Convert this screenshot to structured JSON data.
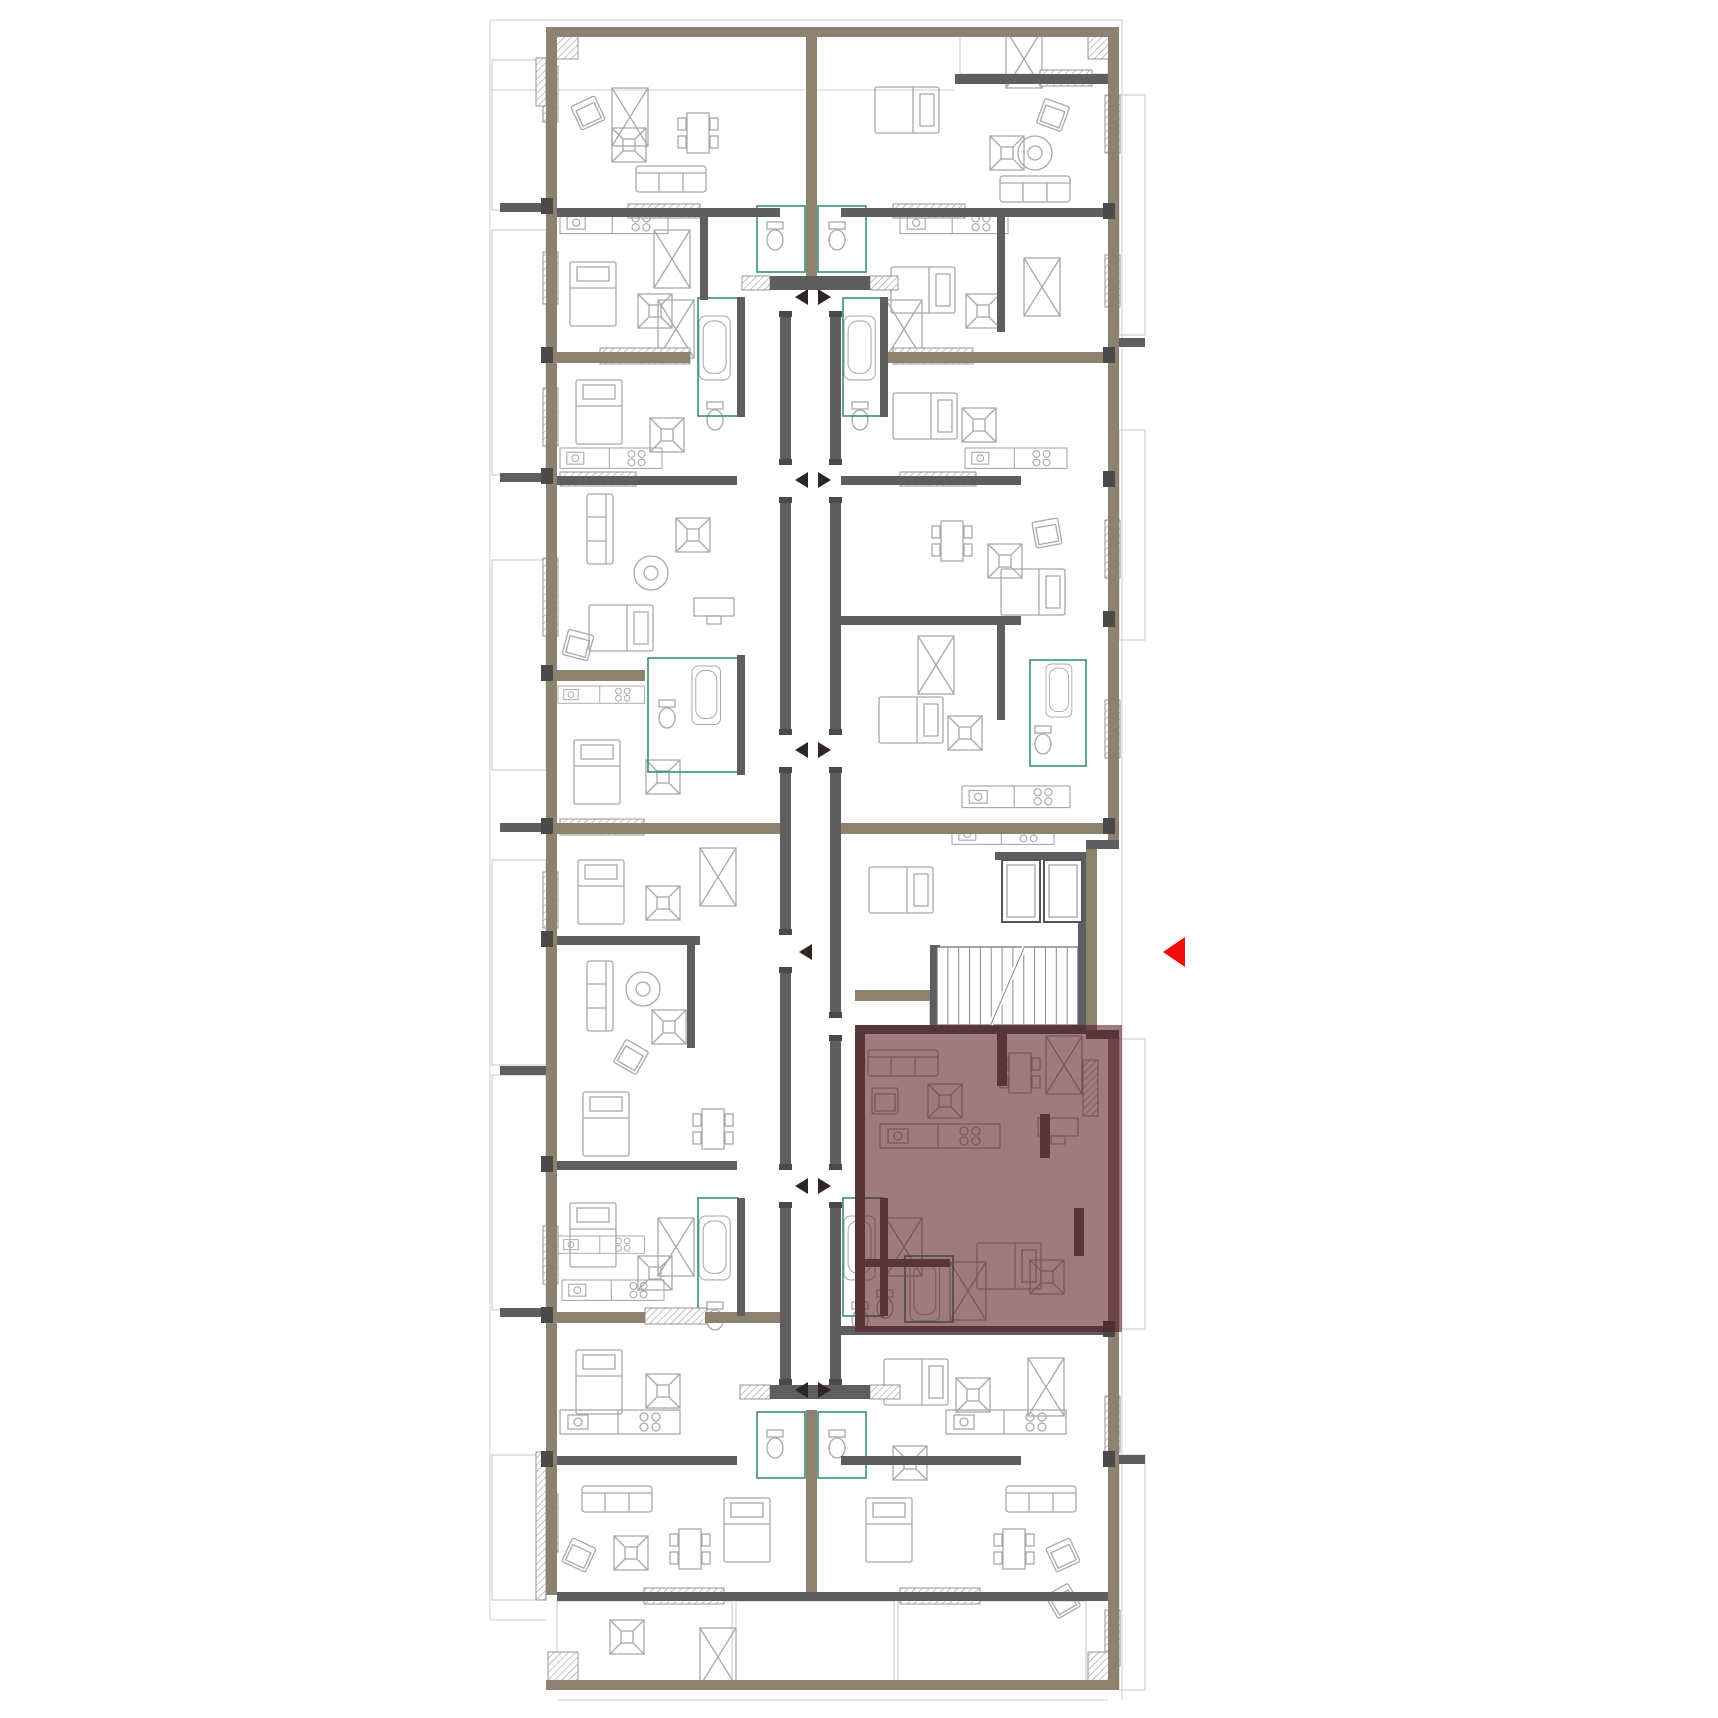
{
  "canvas": {
    "w": 1718,
    "h": 1718,
    "bg": "#ffffff"
  },
  "colors": {
    "wall_olive": "#8d8170",
    "wall_gray": "#5e5e5e",
    "furniture_line": "#a9a9a9",
    "balcony_line": "#c7c7c7",
    "bathroom_green": "#3d8f6e",
    "marker_dark": "#2f2624",
    "highlight_fill": "rgba(84,22,34,0.57)",
    "arrow_red": "#f20d0d",
    "hatch_line": "#9a9a9a"
  },
  "guide_lines": [
    [
      490,
      20,
      1122,
      20
    ],
    [
      490,
      90,
      955,
      90
    ],
    [
      490,
      20,
      490,
      1620
    ],
    [
      1122,
      20,
      1122,
      1700
    ],
    [
      557,
      1700,
      1108,
      1700
    ],
    [
      490,
      1620,
      546,
      1620
    ]
  ],
  "balconies": [
    [
      492,
      60,
      54,
      150
    ],
    [
      492,
      230,
      54,
      245
    ],
    [
      492,
      560,
      54,
      210
    ],
    [
      492,
      860,
      54,
      205
    ],
    [
      492,
      1075,
      54,
      235
    ],
    [
      492,
      1455,
      54,
      145
    ],
    [
      1119,
      95,
      26,
      240
    ],
    [
      1119,
      430,
      26,
      210
    ],
    [
      1119,
      1039,
      26,
      290
    ],
    [
      1119,
      1455,
      26,
      235
    ],
    [
      557,
      1601,
      175,
      80
    ],
    [
      736,
      1601,
      158,
      80
    ],
    [
      898,
      1601,
      188,
      80
    ],
    [
      960,
      32,
      148,
      42
    ]
  ],
  "green_rooms": [
    [
      757,
      206,
      48,
      66
    ],
    [
      818,
      206,
      48,
      66
    ],
    [
      698,
      298,
      40,
      118
    ],
    [
      843,
      298,
      40,
      118
    ],
    [
      648,
      658,
      90,
      114
    ],
    [
      1030,
      660,
      56,
      106
    ],
    [
      698,
      1198,
      40,
      118
    ],
    [
      843,
      1198,
      40,
      118
    ],
    [
      757,
      1412,
      48,
      66
    ],
    [
      818,
      1412,
      48,
      66
    ],
    [
      905,
      1256,
      48,
      66
    ]
  ],
  "furniture": [
    [
      "armchair",
      575,
      100,
      -25
    ],
    [
      "table",
      612,
      128,
      0
    ],
    [
      "dining",
      678,
      106,
      0
    ],
    [
      "sofa",
      636,
      166,
      0
    ],
    [
      "ward",
      612,
      88,
      0
    ],
    [
      "bed",
      884,
      78,
      90
    ],
    [
      "table",
      990,
      136,
      0
    ],
    [
      "round",
      1018,
      136,
      0
    ],
    [
      "armchair",
      1040,
      102,
      20
    ],
    [
      "sofa",
      1000,
      176,
      0
    ],
    [
      "ward",
      1006,
      30,
      0
    ],
    [
      "kitchen",
      560,
      212,
      0,
      0.9
    ],
    [
      "kitchen",
      900,
      212,
      0,
      0.9
    ],
    [
      "toilet",
      764,
      222,
      0
    ],
    [
      "toilet",
      826,
      222,
      0
    ],
    [
      "bed",
      570,
      262,
      0
    ],
    [
      "table",
      638,
      294,
      0
    ],
    [
      "ward",
      654,
      230,
      0
    ],
    [
      "bed",
      900,
      258,
      90
    ],
    [
      "table",
      966,
      294,
      0
    ],
    [
      "ward",
      1024,
      258,
      0
    ],
    [
      "tub",
      699,
      316,
      0,
      0.82
    ],
    [
      "tub",
      844,
      316,
      0,
      0.82
    ],
    [
      "toilet",
      704,
      402,
      0
    ],
    [
      "toilet",
      849,
      402,
      0
    ],
    [
      "ward",
      658,
      300,
      0
    ],
    [
      "ward",
      886,
      300,
      0
    ],
    [
      "bed",
      576,
      380,
      0
    ],
    [
      "table",
      650,
      418,
      0
    ],
    [
      "kitchen",
      560,
      448,
      0,
      0.85
    ],
    [
      "bed",
      902,
      384,
      90
    ],
    [
      "table",
      962,
      408,
      0
    ],
    [
      "kitchen",
      965,
      448,
      0,
      0.85
    ],
    [
      "sofa",
      565,
      516,
      90
    ],
    [
      "round",
      634,
      556,
      0
    ],
    [
      "table",
      676,
      518,
      0
    ],
    [
      "bed",
      598,
      596,
      90
    ],
    [
      "armchair",
      565,
      632,
      15
    ],
    [
      "desk",
      694,
      598,
      0
    ],
    [
      "dining",
      932,
      514,
      0
    ],
    [
      "table",
      988,
      544,
      0
    ],
    [
      "armchair",
      1034,
      520,
      -10
    ],
    [
      "bed",
      1010,
      560,
      90
    ],
    [
      "kitchen",
      558,
      686,
      0,
      0.72
    ],
    [
      "bed",
      574,
      740,
      0
    ],
    [
      "table",
      646,
      760,
      0
    ],
    [
      "tub",
      692,
      666,
      0,
      0.75
    ],
    [
      "toilet",
      656,
      700,
      0
    ],
    [
      "bed",
      888,
      688,
      90
    ],
    [
      "table",
      948,
      716,
      0
    ],
    [
      "ward",
      918,
      636,
      0
    ],
    [
      "kitchen",
      962,
      786,
      0,
      0.9
    ],
    [
      "tub",
      1046,
      664,
      0,
      0.68
    ],
    [
      "toilet",
      1032,
      726,
      0
    ],
    [
      "bed",
      578,
      860,
      0
    ],
    [
      "table",
      646,
      886,
      0
    ],
    [
      "ward",
      700,
      848,
      0
    ],
    [
      "bed",
      878,
      858,
      90
    ],
    [
      "kitchen",
      952,
      824,
      0,
      0.85
    ],
    [
      "sofa",
      565,
      983,
      90
    ],
    [
      "round",
      626,
      972,
      0
    ],
    [
      "table",
      652,
      1010,
      0
    ],
    [
      "armchair",
      618,
      1044,
      30
    ],
    [
      "bed",
      583,
      1092,
      0
    ],
    [
      "dining",
      693,
      1102,
      0
    ],
    [
      "sofa",
      868,
      1050,
      0
    ],
    [
      "armchair",
      872,
      1088,
      0
    ],
    [
      "table",
      928,
      1084,
      0
    ],
    [
      "dining",
      1000,
      1046,
      0
    ],
    [
      "ward",
      1046,
      1036,
      0
    ],
    [
      "kitchen",
      880,
      1124,
      0
    ],
    [
      "desk",
      1038,
      1118,
      0
    ],
    [
      "bed",
      986,
      1234,
      90
    ],
    [
      "table",
      1030,
      1260,
      0
    ],
    [
      "tub",
      910,
      1260,
      0,
      0.78
    ],
    [
      "toilet",
      874,
      1290,
      0
    ],
    [
      "ward",
      950,
      1262,
      0
    ],
    [
      "bed",
      570,
      1203,
      0
    ],
    [
      "kitchen",
      558,
      1236,
      0,
      0.72
    ],
    [
      "table",
      638,
      1256,
      0
    ],
    [
      "tub",
      699,
      1216,
      0,
      0.82
    ],
    [
      "tub",
      844,
      1216,
      0,
      0.82
    ],
    [
      "toilet",
      704,
      1302,
      0
    ],
    [
      "toilet",
      849,
      1302,
      0
    ],
    [
      "ward",
      658,
      1218,
      0
    ],
    [
      "ward",
      886,
      1218,
      0
    ],
    [
      "kitchen",
      562,
      1280,
      0,
      0.85
    ],
    [
      "bed",
      576,
      1350,
      0
    ],
    [
      "table",
      646,
      1374,
      0
    ],
    [
      "bed",
      893,
      1350,
      90
    ],
    [
      "table",
      956,
      1378,
      0
    ],
    [
      "ward",
      1028,
      1358,
      0
    ],
    [
      "kitchen",
      560,
      1410,
      0
    ],
    [
      "sofa",
      582,
      1486,
      0
    ],
    [
      "table",
      614,
      1536,
      0
    ],
    [
      "armchair",
      566,
      1542,
      25
    ],
    [
      "dining",
      670,
      1522,
      0
    ],
    [
      "bed",
      724,
      1498,
      0
    ],
    [
      "kitchen",
      946,
      1410,
      0
    ],
    [
      "sofa",
      1006,
      1486,
      0
    ],
    [
      "table",
      893,
      1446,
      0
    ],
    [
      "dining",
      994,
      1522,
      0
    ],
    [
      "armchair",
      1050,
      1542,
      -25
    ],
    [
      "bed",
      866,
      1498,
      0
    ],
    [
      "toilet",
      764,
      1430,
      0
    ],
    [
      "toilet",
      826,
      1430,
      0
    ],
    [
      "table",
      610,
      1620,
      0
    ],
    [
      "ward",
      700,
      1628,
      0
    ],
    [
      "armchair",
      1050,
      1588,
      -30
    ]
  ],
  "windows": [
    [
      543,
      66,
      15,
      56
    ],
    [
      543,
      252,
      15,
      52
    ],
    [
      543,
      388,
      15,
      58
    ],
    [
      543,
      558,
      15,
      78
    ],
    [
      543,
      872,
      15,
      56
    ],
    [
      543,
      1226,
      15,
      58
    ],
    [
      543,
      1494,
      15,
      58
    ],
    [
      1105,
      95,
      15,
      58
    ],
    [
      1105,
      255,
      15,
      52
    ],
    [
      1105,
      520,
      15,
      58
    ],
    [
      1105,
      700,
      15,
      58
    ],
    [
      1105,
      1396,
      15,
      56
    ],
    [
      1105,
      1610,
      15,
      56
    ],
    [
      1083,
      1060,
      15,
      56
    ],
    [
      600,
      348,
      90,
      16
    ],
    [
      893,
      348,
      80,
      16
    ],
    [
      560,
      819,
      84,
      16
    ],
    [
      645,
      1308,
      62,
      16
    ],
    [
      628,
      204,
      72,
      14
    ],
    [
      893,
      204,
      72,
      14
    ],
    [
      560,
      472,
      76,
      14
    ],
    [
      900,
      472,
      76,
      14
    ],
    [
      1040,
      70,
      52,
      16
    ],
    [
      644,
      1588,
      80,
      16
    ],
    [
      900,
      1588,
      80,
      16
    ],
    [
      742,
      276,
      28,
      14
    ],
    [
      870,
      276,
      28,
      14
    ],
    [
      740,
      1385,
      30,
      14
    ],
    [
      870,
      1385,
      30,
      14
    ],
    [
      930,
      1000,
      14,
      24
    ],
    [
      548,
      29,
      30,
      30
    ],
    [
      1088,
      29,
      30,
      30
    ],
    [
      548,
      1652,
      30,
      30
    ],
    [
      1088,
      1652,
      30,
      30
    ],
    [
      536,
      58,
      10,
      48
    ],
    [
      536,
      1452,
      10,
      148
    ]
  ],
  "walls_olive": [
    [
      546,
      27,
      573,
      10
    ],
    [
      546,
      27,
      11,
      1568
    ],
    [
      1108,
      27,
      11,
      813
    ],
    [
      1086,
      849,
      11,
      190
    ],
    [
      1108,
      1039,
      11,
      651
    ],
    [
      546,
      1680,
      573,
      10
    ],
    [
      557,
      352,
      133,
      11
    ],
    [
      888,
      352,
      217,
      11
    ],
    [
      557,
      670,
      88,
      11
    ],
    [
      557,
      823,
      226,
      11
    ],
    [
      841,
      823,
      267,
      11
    ],
    [
      855,
      990,
      78,
      11
    ],
    [
      557,
      1312,
      88,
      11
    ],
    [
      705,
      1312,
      78,
      11
    ],
    [
      806,
      27,
      11,
      249
    ],
    [
      806,
      1410,
      11,
      182
    ]
  ],
  "walls_gray": [
    [
      557,
      208,
      223,
      9
    ],
    [
      841,
      208,
      267,
      9
    ],
    [
      955,
      74,
      153,
      10
    ],
    [
      557,
      476,
      180,
      9
    ],
    [
      841,
      476,
      180,
      9
    ],
    [
      841,
      616,
      180,
      9
    ],
    [
      997,
      616,
      8,
      104
    ],
    [
      557,
      936,
      143,
      9
    ],
    [
      557,
      1161,
      180,
      9
    ],
    [
      865,
      1259,
      85,
      8
    ],
    [
      841,
      1326,
      267,
      9
    ],
    [
      557,
      1456,
      180,
      9
    ],
    [
      841,
      1456,
      180,
      9
    ],
    [
      557,
      1592,
      551,
      9
    ],
    [
      780,
      311,
      11,
      154
    ],
    [
      780,
      497,
      11,
      238
    ],
    [
      780,
      767,
      11,
      168
    ],
    [
      780,
      967,
      11,
      203
    ],
    [
      780,
      1202,
      11,
      183
    ],
    [
      830,
      311,
      11,
      154
    ],
    [
      830,
      497,
      11,
      238
    ],
    [
      830,
      767,
      11,
      251
    ],
    [
      830,
      1035,
      11,
      135
    ],
    [
      830,
      1202,
      11,
      183
    ],
    [
      770,
      276,
      100,
      14
    ],
    [
      770,
      1385,
      100,
      14
    ],
    [
      995,
      852,
      91,
      8
    ],
    [
      1078,
      852,
      8,
      175
    ],
    [
      930,
      945,
      10,
      82
    ],
    [
      930,
      1018,
      156,
      8
    ],
    [
      737,
      297,
      8,
      120
    ],
    [
      880,
      297,
      8,
      120
    ],
    [
      737,
      655,
      8,
      120
    ],
    [
      700,
      212,
      8,
      88
    ],
    [
      737,
      1198,
      8,
      118
    ],
    [
      880,
      1198,
      8,
      118
    ],
    [
      687,
      940,
      8,
      108
    ],
    [
      997,
      212,
      8,
      120
    ],
    [
      1040,
      1114,
      10,
      44
    ],
    [
      1074,
      1208,
      10,
      48
    ],
    [
      997,
      1028,
      10,
      58
    ],
    [
      855,
      1025,
      10,
      305
    ],
    [
      855,
      1025,
      231,
      9
    ],
    [
      500,
      203,
      46,
      9
    ],
    [
      500,
      473,
      46,
      9
    ],
    [
      500,
      823,
      46,
      9
    ],
    [
      500,
      1066,
      46,
      9
    ],
    [
      500,
      1308,
      46,
      9
    ],
    [
      1119,
      338,
      26,
      9
    ],
    [
      1119,
      1455,
      26,
      9
    ],
    [
      1086,
      840,
      33,
      9
    ],
    [
      1086,
      1030,
      33,
      9
    ]
  ],
  "piers": [
    [
      541,
      198
    ],
    [
      541,
      347
    ],
    [
      541,
      468
    ],
    [
      541,
      665
    ],
    [
      541,
      818
    ],
    [
      541,
      931
    ],
    [
      541,
      1156
    ],
    [
      541,
      1307
    ],
    [
      541,
      1451
    ],
    [
      1103,
      203
    ],
    [
      1103,
      347
    ],
    [
      1103,
      471
    ],
    [
      1103,
      611
    ],
    [
      1103,
      818
    ],
    [
      1103,
      1321
    ],
    [
      1103,
      1451
    ]
  ],
  "core": {
    "stairs": {
      "x": 937,
      "y": 947,
      "w": 141,
      "h": 78,
      "treads": 13
    },
    "elevators": [
      [
        1002,
        860,
        38,
        62
      ],
      [
        1044,
        860,
        38,
        62
      ]
    ]
  },
  "door_markers": {
    "pair_y": [
      297,
      480,
      750,
      1186,
      1390
    ],
    "single": [
      {
        "y": 952
      }
    ],
    "left_tip_x": 795,
    "left_base_x": 808,
    "right_base_x": 818,
    "right_tip_x": 831,
    "half_h": 8
  },
  "highlight": {
    "x": 855,
    "y": 1025,
    "w": 267,
    "h": 307
  },
  "pointer_arrow": {
    "points": [
      [
        1163,
        952
      ],
      [
        1185,
        937
      ],
      [
        1185,
        967
      ]
    ]
  }
}
